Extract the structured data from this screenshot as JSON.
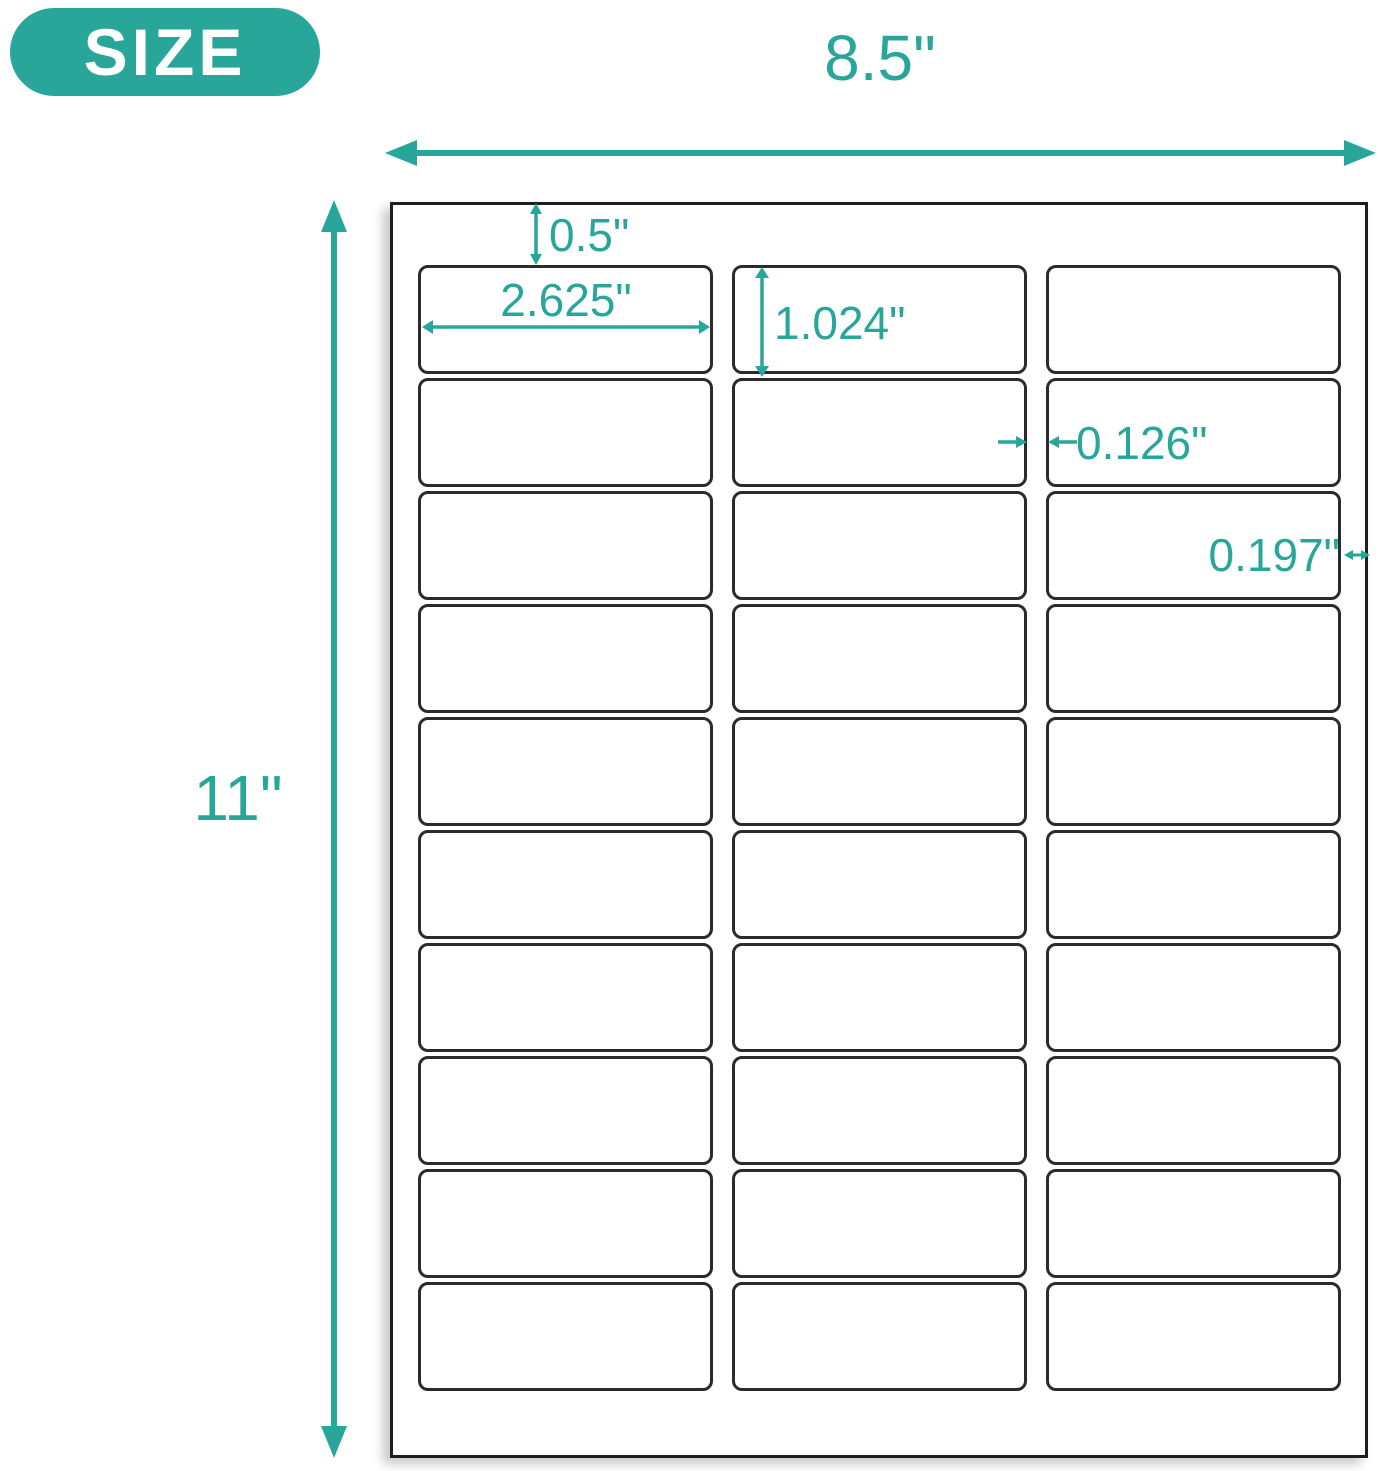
{
  "badge": {
    "label": "SIZE"
  },
  "colors": {
    "accent": "#29a69a",
    "label_border": "#2b2b2b",
    "sheet_border": "#1e1e1e",
    "badge_text": "#ffffff",
    "sheet_background": "#ffffff"
  },
  "sheet": {
    "grid": {
      "rows": 10,
      "columns": 3,
      "label_count": 30
    }
  },
  "dimensions": {
    "sheet_width": "8.5\"",
    "sheet_height": "11\"",
    "top_margin": "0.5\"",
    "label_width": "2.625\"",
    "label_height": "1.024\"",
    "column_gap": "0.126\"",
    "right_margin": "0.197\""
  }
}
